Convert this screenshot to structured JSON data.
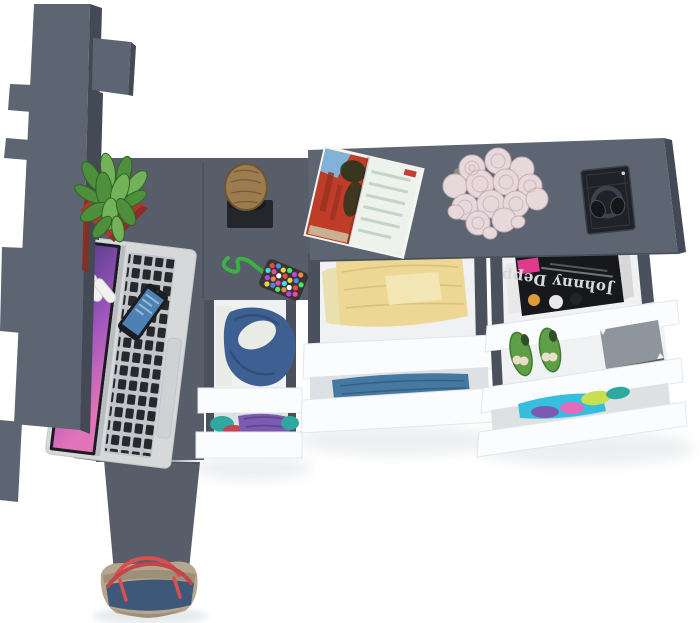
{
  "meta": {
    "title": "Top-down 3D render of a gray furniture set (wardrobe, L-shaped desk and chests with open drawers)",
    "view": "bird's-eye product render on white background"
  },
  "labels": {
    "magazine_cover_text": "Johnny Depp"
  },
  "palette": {
    "bg": "#ffffff",
    "furn_top": "#575e6a",
    "furn_top_light": "#5e6572",
    "furn_side": "#434a55",
    "furn_edge": "#394049",
    "drawer_interior": "#eff1f2",
    "drawer_interior_shade": "#dde1e4",
    "drawer_rail": "#4a515c",
    "drawer_front": "#fbfcfd",
    "drawer_front_edge": "#e3e7ea",
    "shadow": "#dfe3e6",
    "poster_red": "#8a2e1c",
    "pot_red": "#a93a31",
    "pot_red_dark": "#8c2d26",
    "plant_green": "#4e8f3c",
    "plant_green_dark": "#2f6526",
    "plant_green_light": "#74b25a",
    "wood": "#9c7b4e",
    "wood_dark": "#6e5432",
    "mat_black": "#23262a",
    "cord_green": "#3cb043",
    "pouch_base": "#3a3430",
    "laptop_silver": "#d6d8da",
    "laptop_silver_dark": "#b9bcc0",
    "laptop_key": "#26282b",
    "keyboard_bed": "#c2c5c9",
    "trackpad": "#cfd2d5",
    "screen_purple_1": "#4d3a85",
    "screen_purple_2": "#a055be",
    "screen_pink": "#e273b8",
    "phone_black": "#1b1d21",
    "phone_screen": "#4d80b3",
    "phone_screen_light": "#a6c8e2",
    "scissors_white": "#f1f1ef",
    "mag_photo_red": "#bf3d28",
    "mag_photo_red_dark": "#972f1f",
    "mag_photo_sky": "#82b2d8",
    "mag_photo_dark": "#2a351f",
    "mag_page": "#edf2ec",
    "mag_page_line": "#c5d4c8",
    "mag_accent_red": "#c23f33",
    "rose_pink": "#e7d8db",
    "rose_pink_dark": "#c6afb6",
    "rose_leaf": "#8a8f78",
    "box_black": "#1f2226",
    "box_black_edge": "#3c4148",
    "headphone_dark": "#141619",
    "mag_cover_dark": "#17181b",
    "mag_cover_text": "#d8d9dc",
    "mag_pink": "#df3a8e",
    "mag_orange": "#e09a38",
    "mag_white": "#e8e8e8",
    "shoe_green": "#5f9e49",
    "shoe_green_dark": "#417a30",
    "bow_cream": "#e9dfc9",
    "box_gray": "#8f959d",
    "box_gray_dark": "#5d6269",
    "cloth_yellow": "#ecd795",
    "cloth_yellow_dark": "#d8bc71",
    "cloth_yellow_pale": "#f2e6b4",
    "cloth_cream": "#eadfae",
    "cloth_blue": "#4679a1",
    "cloth_blue_dark": "#34617f",
    "hoodie_blue": "#3d5f92",
    "hoodie_blue_dark": "#2c4a77",
    "shirt_white": "#e9ebe5",
    "cloth_purple": "#7b5bb0",
    "cloth_purple_dark": "#5d4390",
    "cloth_teal": "#2fa8a0",
    "cloth_red": "#c04556",
    "cloth_cyan": "#35bfdf",
    "cloth_lime": "#c8df52",
    "cloth_pink": "#e86ac0",
    "bag_beige": "#b5a78e",
    "bag_beige_dark": "#9e9078",
    "bag_navy": "#3d5878",
    "bag_red": "#d94f52"
  },
  "scene": {
    "background": "#ffffff",
    "objects": [
      {
        "name": "wardrobe-column",
        "label": "Tall gray wardrobe seen from above with side shelf tabs",
        "color": "furn_top_light"
      },
      {
        "name": "desk",
        "label": "L-shaped gray desk surface",
        "color": "furn_top"
      },
      {
        "name": "potted-plant",
        "label": "Green succulent in square red pot",
        "color": "plant_green"
      },
      {
        "name": "log-stool",
        "label": "Wooden log stool on black mat",
        "color": "wood"
      },
      {
        "name": "beaded-pouch",
        "label": "Multicolor beaded pouch with green cord",
        "color": "cord_green"
      },
      {
        "name": "scissors",
        "label": "White-handled scissors",
        "color": "scissors_white"
      },
      {
        "name": "smartphone",
        "label": "Smartphone with blue screen",
        "color": "phone_screen"
      },
      {
        "name": "laptop",
        "label": "Open silver laptop with purple wallpaper",
        "color": "laptop_silver"
      },
      {
        "name": "left-chest",
        "label": "Two open drawers with blue hoodie, white shirt and purple/teal clothes"
      },
      {
        "name": "middle-chest",
        "label": "Two open drawers with folded yellow and blue clothes"
      },
      {
        "name": "right-chest",
        "label": "Three open drawers with magazines, green shoes, gray box and bright clothes"
      },
      {
        "name": "dresser-top",
        "label": "Long dresser top",
        "color": "furn_top_light"
      },
      {
        "name": "open-magazine",
        "label": "Open magazine showing red building photo",
        "color": "mag_photo_red"
      },
      {
        "name": "rose-bouquet",
        "label": "Bouquet of pale pink roses with loose petals",
        "color": "rose_pink"
      },
      {
        "name": "headphones-box",
        "label": "Headphones in open black box",
        "color": "box_black"
      },
      {
        "name": "tote-bag",
        "label": "Beige canvas tote with navy band and red straps",
        "color": "bag_navy"
      }
    ]
  }
}
